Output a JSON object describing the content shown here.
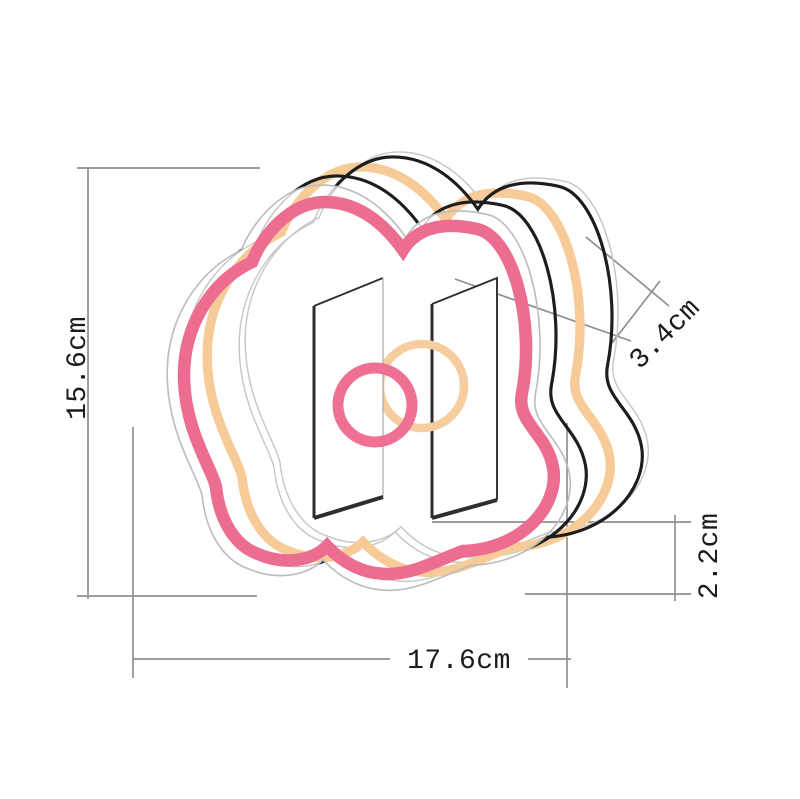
{
  "diagram": {
    "dimensions": {
      "height": "15.6cm",
      "width": "17.6cm",
      "depth": "3.4cm",
      "thickness": "2.2cm"
    },
    "colors": {
      "neon_pink": "#ed6d90",
      "neon_orange": "#f6cb98",
      "back_outline": "#1d1d1d",
      "front_outline": "#bdbdbd",
      "ghost_line": "#c6c6c6",
      "dimension_line": "#8f8f8f",
      "label_text": "#1c1c1c",
      "logo_pink_ring": "#ee7093",
      "logo_orange_ring": "#f6cd9e"
    }
  }
}
